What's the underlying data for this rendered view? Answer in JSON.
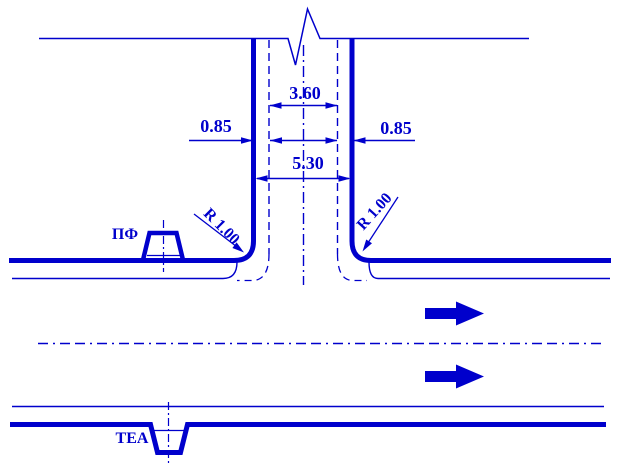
{
  "drawing": {
    "type": "road T-junction plan (CAD technical drawing)",
    "colors": {
      "ink": "#0000cc",
      "background": "#ffffff"
    },
    "dimensions": {
      "carriageway_width": "3.60",
      "left_edge_strip": "0.85",
      "right_edge_strip": "0.85",
      "total_width": "5.30"
    },
    "radius_labels": {
      "left": "R 1.00",
      "right": "R 1.00"
    },
    "feature_labels": {
      "pf": "ПФ",
      "tea": "ТЕА"
    },
    "symbols": {
      "break_symbol": "zigzag line break on top edge",
      "direction_arrows": "two solid block arrows pointing right"
    }
  }
}
